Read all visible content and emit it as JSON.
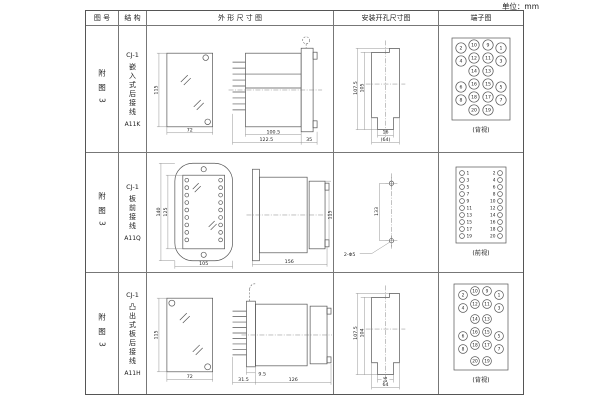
{
  "unit_label": "单位：mm",
  "headers": {
    "fig_no": "图 号",
    "structure": "结 构",
    "outline": "外 形 尺 寸 图",
    "mounting": "安装开孔尺寸图",
    "terminal": "端子图"
  },
  "rows": [
    {
      "fig_no": "附图3",
      "model": "CJ-1",
      "structure": "嵌入式后接线",
      "code": "A11K",
      "dims": {
        "front_h": "115",
        "front_w": "72",
        "body": "100.5",
        "total": "122.5",
        "flange": "35"
      },
      "mount": {
        "h_outer": "107.5",
        "h_inner": "105",
        "w_slot": "16",
        "w_outer": "(64)"
      },
      "view": "(背视)"
    },
    {
      "fig_no": "附图3",
      "model": "CJ-1",
      "structure": "板前接线",
      "code": "A11Q",
      "dims": {
        "front_h_outer": "140",
        "front_h_inner": "125",
        "front_w": "105",
        "side_len": "156",
        "side_h": "115"
      },
      "mount": {
        "spacing": "133",
        "holes": "2-Φ5"
      },
      "view": "(前视)"
    },
    {
      "fig_no": "附图3",
      "model": "CJ-1",
      "structure": "凸出式板后接线",
      "code": "A11H",
      "dims": {
        "front_h": "115",
        "front_w": "72",
        "plate": "9.5",
        "front_len": "31.5",
        "side_len": "126"
      },
      "mount": {
        "h_outer": "107.5",
        "h_inner": "104",
        "w_slot": "16",
        "w_outer": "64"
      },
      "view": "(背视)"
    }
  ],
  "terminal_rear": {
    "rows": [
      [
        "2",
        "10",
        "9",
        "1"
      ],
      [
        "4",
        "12",
        "11",
        "3"
      ],
      [
        "",
        "14",
        "13",
        ""
      ],
      [
        "6",
        "16",
        "15",
        "5"
      ],
      [
        "8",
        "18",
        "17",
        "7"
      ],
      [
        "",
        "20",
        "19",
        ""
      ]
    ]
  },
  "terminal_front": {
    "pairs": [
      [
        "1",
        "2"
      ],
      [
        "3",
        "4"
      ],
      [
        "5",
        "6"
      ],
      [
        "7",
        "8"
      ],
      [
        "9",
        "10"
      ],
      [
        "11",
        "12"
      ],
      [
        "13",
        "14"
      ],
      [
        "15",
        "16"
      ],
      [
        "17",
        "18"
      ],
      [
        "19",
        "20"
      ]
    ]
  }
}
